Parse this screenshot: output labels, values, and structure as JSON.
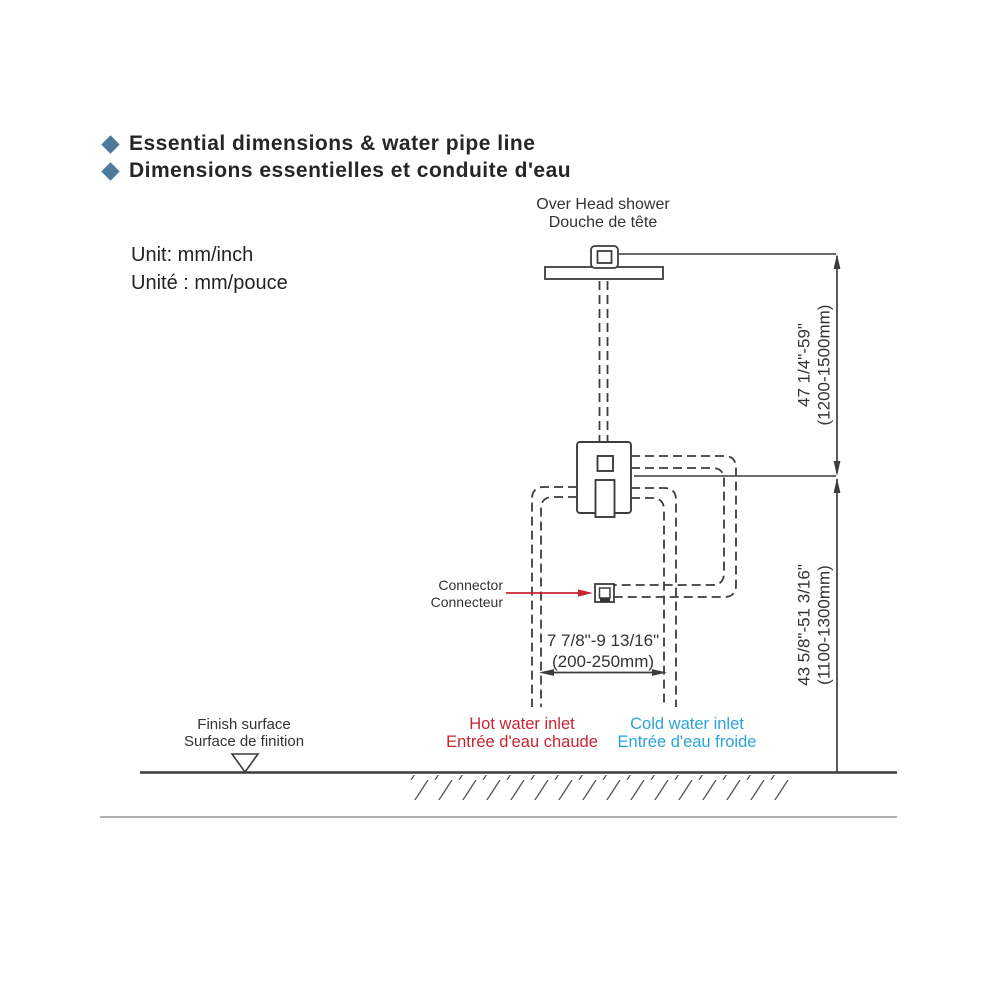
{
  "header": {
    "title_en": "Essential dimensions & water pipe line",
    "title_fr": "Dimensions essentielles et conduite d'eau",
    "unit_en": "Unit: mm/inch",
    "unit_fr": "Unité : mm/pouce"
  },
  "labels": {
    "overhead_shower_en": "Over Head shower",
    "overhead_shower_fr": "Douche de tête",
    "connector_en": "Connector",
    "connector_fr": "Connecteur",
    "finish_surface_en": "Finish surface",
    "finish_surface_fr": "Surface de finition",
    "hot_inlet_en": "Hot water inlet",
    "hot_inlet_fr": "Entrée d'eau chaude",
    "cold_inlet_en": "Cold water inlet",
    "cold_inlet_fr": "Entrée d'eau froide"
  },
  "dimensions": {
    "head_height_inch": "47 1/4\"-59\"",
    "head_height_mm": "(1200-1500mm)",
    "valve_height_inch": "43 5/8\"-51 3/16\"",
    "valve_height_mm": "(1100-1300mm)",
    "inlet_spacing_inch": "7 7/8\"-9 13/16\"",
    "inlet_spacing_mm": "(200-250mm)"
  },
  "colors": {
    "hot": "#c92432",
    "cold": "#2aa3d9",
    "bullet": "#4b7a9b",
    "line": "#3d3d3d"
  }
}
